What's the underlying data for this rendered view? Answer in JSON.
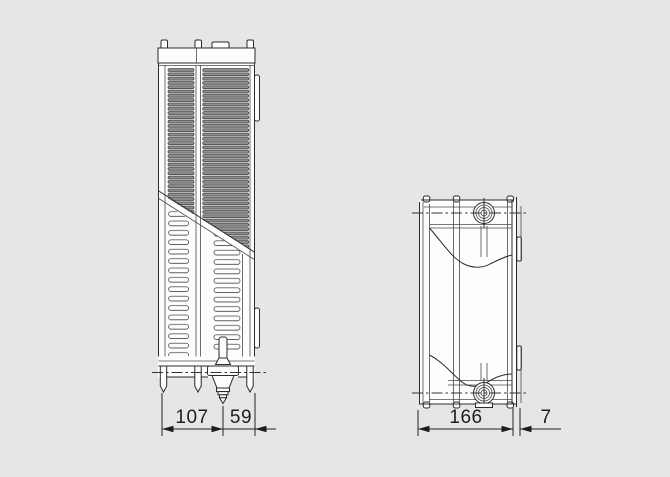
{
  "figure": {
    "description": "Radiator side-view technical drawing with depth dimensions",
    "left_view": {
      "dim_a": "107",
      "dim_b": "59"
    },
    "right_view": {
      "dim_a": "166",
      "dim_b": "7"
    }
  },
  "colors": {
    "background": "#e6e6e6",
    "line": "#2b2b2b",
    "dimension_text": "#1d1d22",
    "louver_fill": "#8f8f8f",
    "body_fill": "#fdfdfd"
  }
}
